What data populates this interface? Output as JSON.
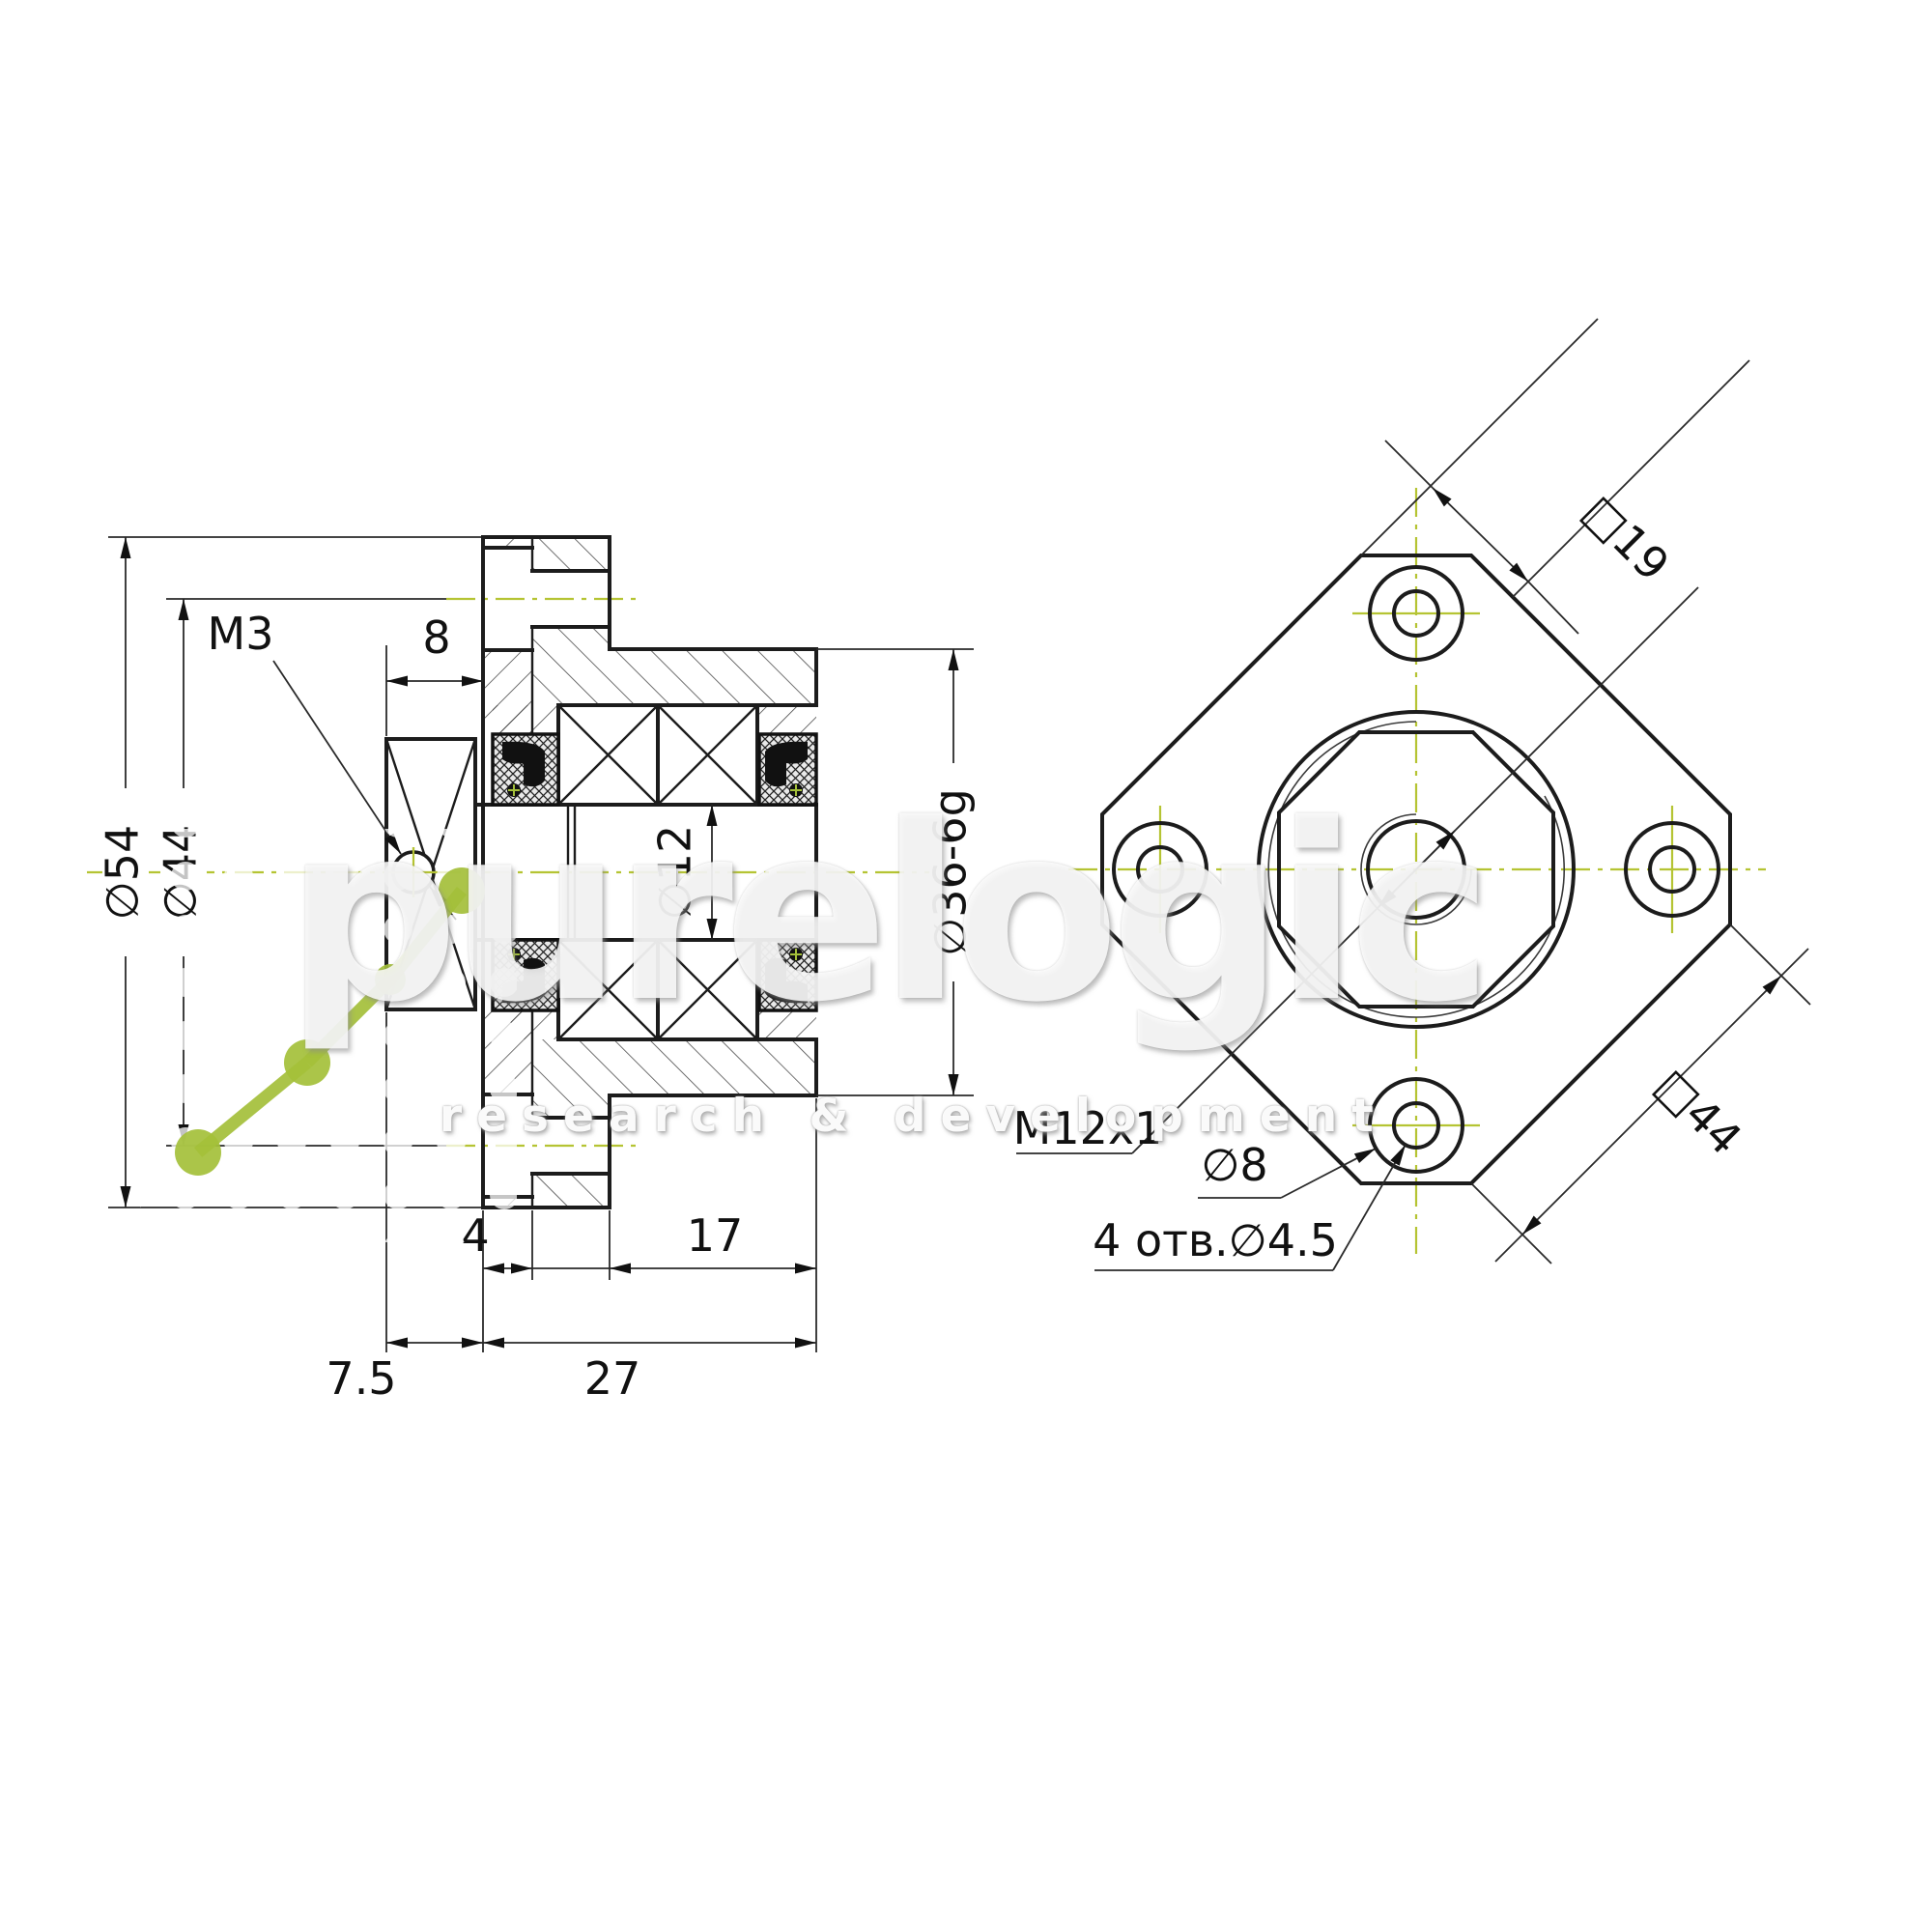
{
  "drawing": {
    "type": "technical-drawing",
    "section_view": {
      "dims": {
        "d54": "∅54",
        "d44": "∅44",
        "m3": "M3",
        "len8": "8",
        "d12": "∅12",
        "d36": "∅36-6g",
        "len4": "4",
        "len17": "17",
        "len75": "7.5",
        "len27": "27"
      }
    },
    "front_view": {
      "dims": {
        "sq19": "□19",
        "sq44": "□44",
        "m12": "M12x1",
        "d8": "∅8",
        "holes": "4 отв.∅4.5"
      }
    },
    "colors": {
      "centerline_green": "#b5c433",
      "logo_green": "#a4c03a",
      "line_black": "#1c1c1c"
    }
  },
  "watermark": {
    "brand": "purelogic",
    "tagline": "research & development"
  }
}
